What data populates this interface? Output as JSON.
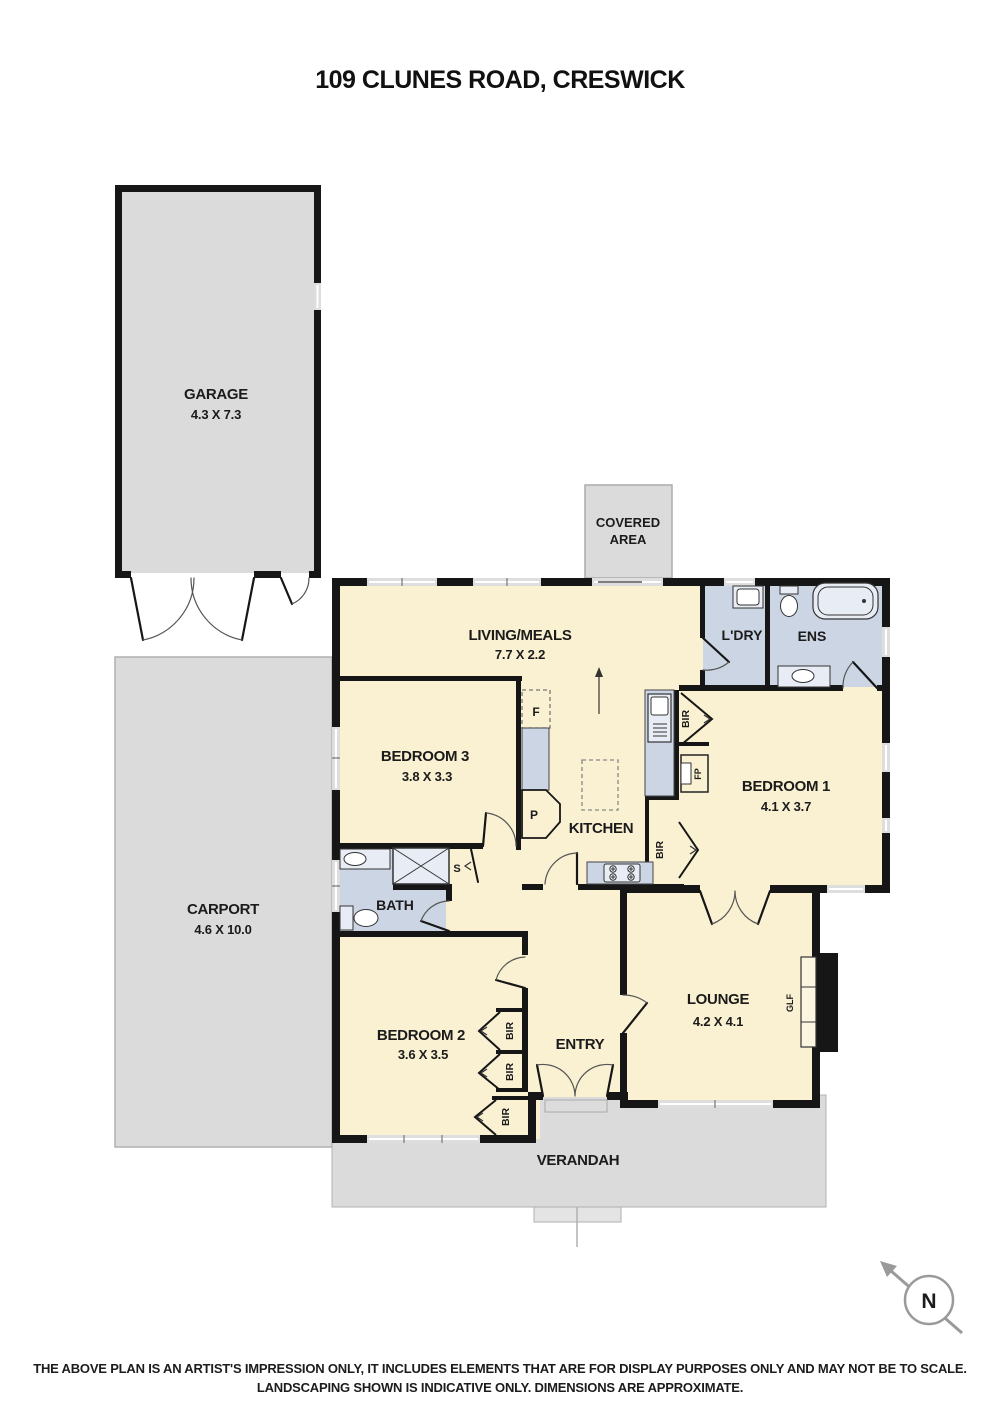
{
  "title": "109 CLUNES ROAD, CRESWICK",
  "outdoor": {
    "garage": {
      "name": "GARAGE",
      "dims": "4.3 X 7.3"
    },
    "carport": {
      "name": "CARPORT",
      "dims": "4.6 X 10.0"
    },
    "covered_area": {
      "line1": "COVERED",
      "line2": "AREA"
    },
    "verandah": {
      "name": "VERANDAH"
    }
  },
  "rooms": {
    "living_meals": {
      "name": "LIVING/MEALS",
      "dims": "7.7 X 2.2"
    },
    "kitchen": {
      "name": "KITCHEN"
    },
    "laundry": {
      "name": "L'DRY"
    },
    "ensuite": {
      "name": "ENS"
    },
    "bedroom1": {
      "name": "BEDROOM 1",
      "dims": "4.1 X 3.7"
    },
    "bedroom2": {
      "name": "BEDROOM 2",
      "dims": "3.6 X 3.5"
    },
    "bedroom3": {
      "name": "BEDROOM 3",
      "dims": "3.8 X 3.3"
    },
    "bath": {
      "name": "BATH"
    },
    "lounge": {
      "name": "LOUNGE",
      "dims": "4.2 X 4.1"
    },
    "entry": {
      "name": "ENTRY"
    }
  },
  "fixtures": {
    "fridge": "F",
    "pantry": "P",
    "store": "S",
    "robe": "BIR",
    "fireplace": "FP",
    "gas_log_fire": "GLF"
  },
  "compass": {
    "north": "N"
  },
  "disclaimer": {
    "line1": "THE ABOVE PLAN IS AN ARTIST'S IMPRESSION ONLY, IT INCLUDES ELEMENTS THAT ARE FOR DISPLAY PURPOSES ONLY AND MAY NOT BE TO SCALE.",
    "line2": "LANDSCAPING SHOWN IS INDICATIVE ONLY. DIMENSIONS ARE APPROXIMATE."
  },
  "colors": {
    "room_fill": "#FAF1D2",
    "wet_area_fill": "#CBD5E3",
    "fixture_fill": "#E8EDF5",
    "outdoor_fill": "#DBDBDB",
    "wall": "#161616"
  }
}
